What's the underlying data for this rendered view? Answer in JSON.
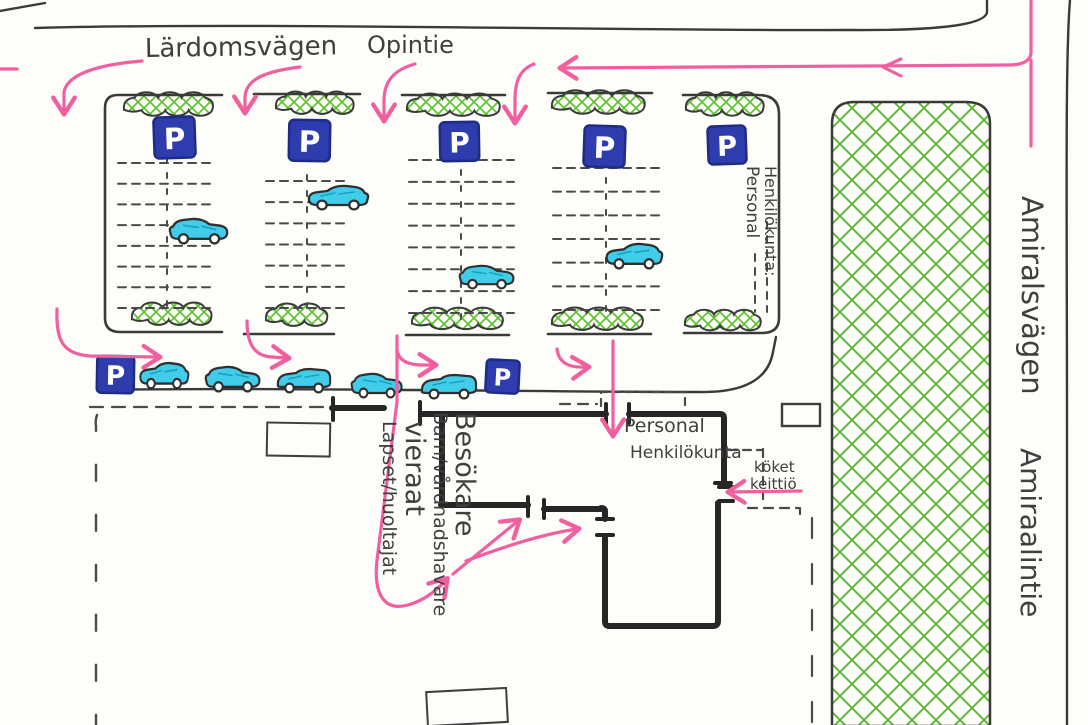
{
  "map": {
    "streets": {
      "top_swedish": "Lärdomsvägen",
      "top_finnish": "Opintie",
      "right_swedish": "Amiralsvägen",
      "right_finnish": "Amiraalintie"
    },
    "labels": {
      "staff_parking": {
        "line1": "Personal",
        "line2": "Henkilökunta:"
      },
      "staff_entrance": {
        "line1": "Personal",
        "line2": "Henkilökunta"
      },
      "kitchen": {
        "line1": "köket",
        "line2": "keittiö"
      },
      "visitors_swedish": {
        "line1": "Barn/vårdnadshavare",
        "line2": "Besökare"
      },
      "visitors_finnish": {
        "line1": "Lapset/huoltajat",
        "line2": "vieraat"
      }
    },
    "signs": {
      "parking_letter": "P"
    },
    "colors": {
      "ink": "#3a3a3a",
      "wall": "#262626",
      "pink": "#f0609f",
      "green": "#5fc32f",
      "green_dark": "#4fae27",
      "blue_sign": "#2e3cae",
      "blue_sign_edge": "#1f2c85",
      "car_cyan": "#41cdea",
      "paper": "#fdfdfa"
    },
    "counts": {
      "parking_bays": 5,
      "parking_signs": 7,
      "cars_in_bays": 4,
      "cars_on_street": 5
    }
  }
}
